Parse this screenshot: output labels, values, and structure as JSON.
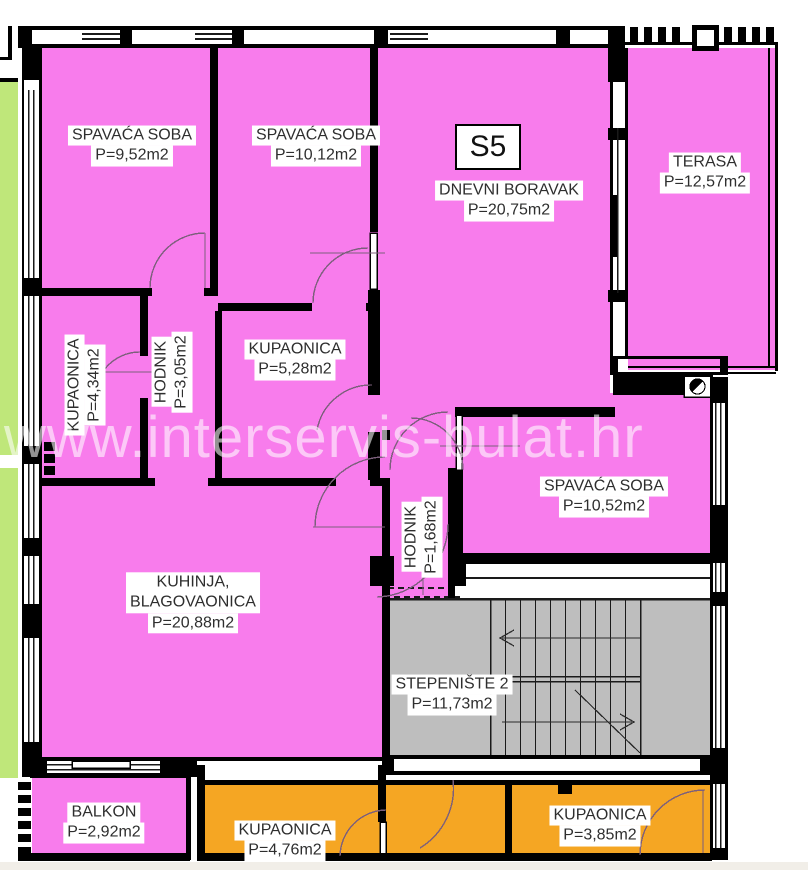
{
  "unit_label": "S5",
  "watermark": "www.interservis-bulat.hr",
  "rooms": {
    "bedroom1": {
      "name": "SPAVAĆA SOBA",
      "area": "P=9,52m2"
    },
    "bedroom2": {
      "name": "SPAVAĆA SOBA",
      "area": "P=10,12m2"
    },
    "living": {
      "name": "DNEVNI BORAVAK",
      "area": "P=20,75m2"
    },
    "terrace": {
      "name": "TERASA",
      "area": "P=12,57m2"
    },
    "bath1": {
      "name": "KUPAONICA",
      "area": "P=4,34m2"
    },
    "hall1": {
      "name": "HODNIK",
      "area": "P=3,05m2"
    },
    "bath2": {
      "name": "KUPAONICA",
      "area": "P=5,28m2"
    },
    "bedroom3": {
      "name": "SPAVAĆA SOBA",
      "area": "P=10,52m2"
    },
    "hall2": {
      "name": "HODNIK",
      "area": "P=1,68m2"
    },
    "kitchen": {
      "name": "KUHINJA,\nBLAGOVAONICA",
      "area": "P=20,88m2"
    },
    "staircase": {
      "name": "STEPENIŠTE 2",
      "area": "P=11,73m2"
    },
    "balcony": {
      "name": "BALKON",
      "area": "P=2,92m2"
    },
    "bath3": {
      "name": "KUPAONICA",
      "area": "P=4,76m2"
    },
    "bath4": {
      "name": "KUPAONICA",
      "area": "P=3,85m2"
    }
  },
  "colors": {
    "room_fill": "#F87CEC",
    "wet_room_fill": "#F5A623",
    "adjacent_fill": "#BFE77A",
    "stair_fill": "#BEBEBE",
    "wall": "#000000",
    "door_arc": "#7C5F7C",
    "label_bg": "#FFFFFF",
    "label_text": "#2E2E2E",
    "watermark": "#FFFFFF"
  }
}
